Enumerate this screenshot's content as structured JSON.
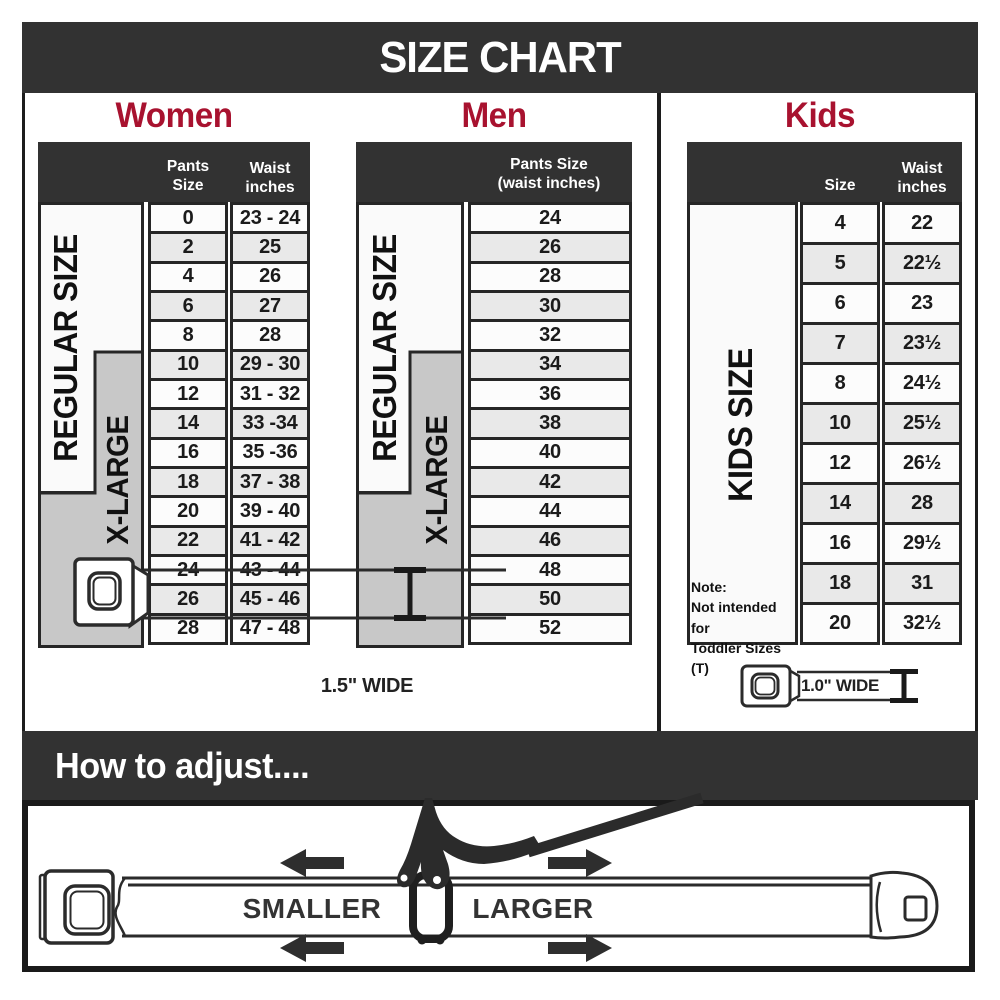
{
  "title": "SIZE CHART",
  "colors": {
    "bar_bg": "#323232",
    "accent_red": "#a8122f",
    "band_gray": "#c8c8c8",
    "band_light": "#fafafa",
    "row_alt": "#e9e9e9",
    "line": "#262626"
  },
  "women": {
    "heading": "Women",
    "col1_header": "Pants Size",
    "col2_header": "Waist\ninches",
    "band_regular": "REGULAR SIZE",
    "band_xlarge": "X-LARGE"
  },
  "men": {
    "heading": "Men",
    "col_header": "Pants Size\n(waist inches)",
    "band_regular": "REGULAR SIZE",
    "band_xlarge": "X-LARGE"
  },
  "kids": {
    "heading": "Kids",
    "col1_header": "Size",
    "col2_header": "Waist\ninches",
    "band": "KIDS SIZE",
    "note": "Note:\nNot intended for\nToddler Sizes (T)"
  },
  "belts": {
    "adult_label": "1.5\" WIDE",
    "kids_label": "1.0\" WIDE"
  },
  "adjust": {
    "heading": "How to adjust....",
    "smaller_label": "SMALLER",
    "larger_label": "LARGER"
  },
  "chart_data": [
    {
      "type": "table",
      "title": "Women",
      "columns": [
        "Pants Size",
        "Waist inches"
      ],
      "bands": [
        "REGULAR SIZE",
        "X-LARGE"
      ],
      "rows": [
        [
          "0",
          "23 - 24"
        ],
        [
          "2",
          "25"
        ],
        [
          "4",
          "26"
        ],
        [
          "6",
          "27"
        ],
        [
          "8",
          "28"
        ],
        [
          "10",
          "29 - 30"
        ],
        [
          "12",
          "31 - 32"
        ],
        [
          "14",
          "33 -34"
        ],
        [
          "16",
          "35 -36"
        ],
        [
          "18",
          "37 - 38"
        ],
        [
          "20",
          "39 - 40"
        ],
        [
          "22",
          "41 - 42"
        ],
        [
          "24",
          "43 - 44"
        ],
        [
          "26",
          "45 - 46"
        ],
        [
          "28",
          "47 - 48"
        ]
      ]
    },
    {
      "type": "table",
      "title": "Men",
      "columns": [
        "Pants Size (waist inches)"
      ],
      "bands": [
        "REGULAR SIZE",
        "X-LARGE"
      ],
      "rows": [
        [
          "24"
        ],
        [
          "26"
        ],
        [
          "28"
        ],
        [
          "30"
        ],
        [
          "32"
        ],
        [
          "34"
        ],
        [
          "36"
        ],
        [
          "38"
        ],
        [
          "40"
        ],
        [
          "42"
        ],
        [
          "44"
        ],
        [
          "46"
        ],
        [
          "48"
        ],
        [
          "50"
        ],
        [
          "52"
        ]
      ]
    },
    {
      "type": "table",
      "title": "Kids",
      "columns": [
        "Size",
        "Waist inches"
      ],
      "bands": [
        "KIDS SIZE"
      ],
      "note": "Note: Not intended for Toddler Sizes (T)",
      "rows": [
        [
          "4",
          "22"
        ],
        [
          "5",
          "22½"
        ],
        [
          "6",
          "23"
        ],
        [
          "7",
          "23½"
        ],
        [
          "8",
          "24½"
        ],
        [
          "10",
          "25½"
        ],
        [
          "12",
          "26½"
        ],
        [
          "14",
          "28"
        ],
        [
          "16",
          "29½"
        ],
        [
          "18",
          "31"
        ],
        [
          "20",
          "32½"
        ]
      ]
    }
  ]
}
